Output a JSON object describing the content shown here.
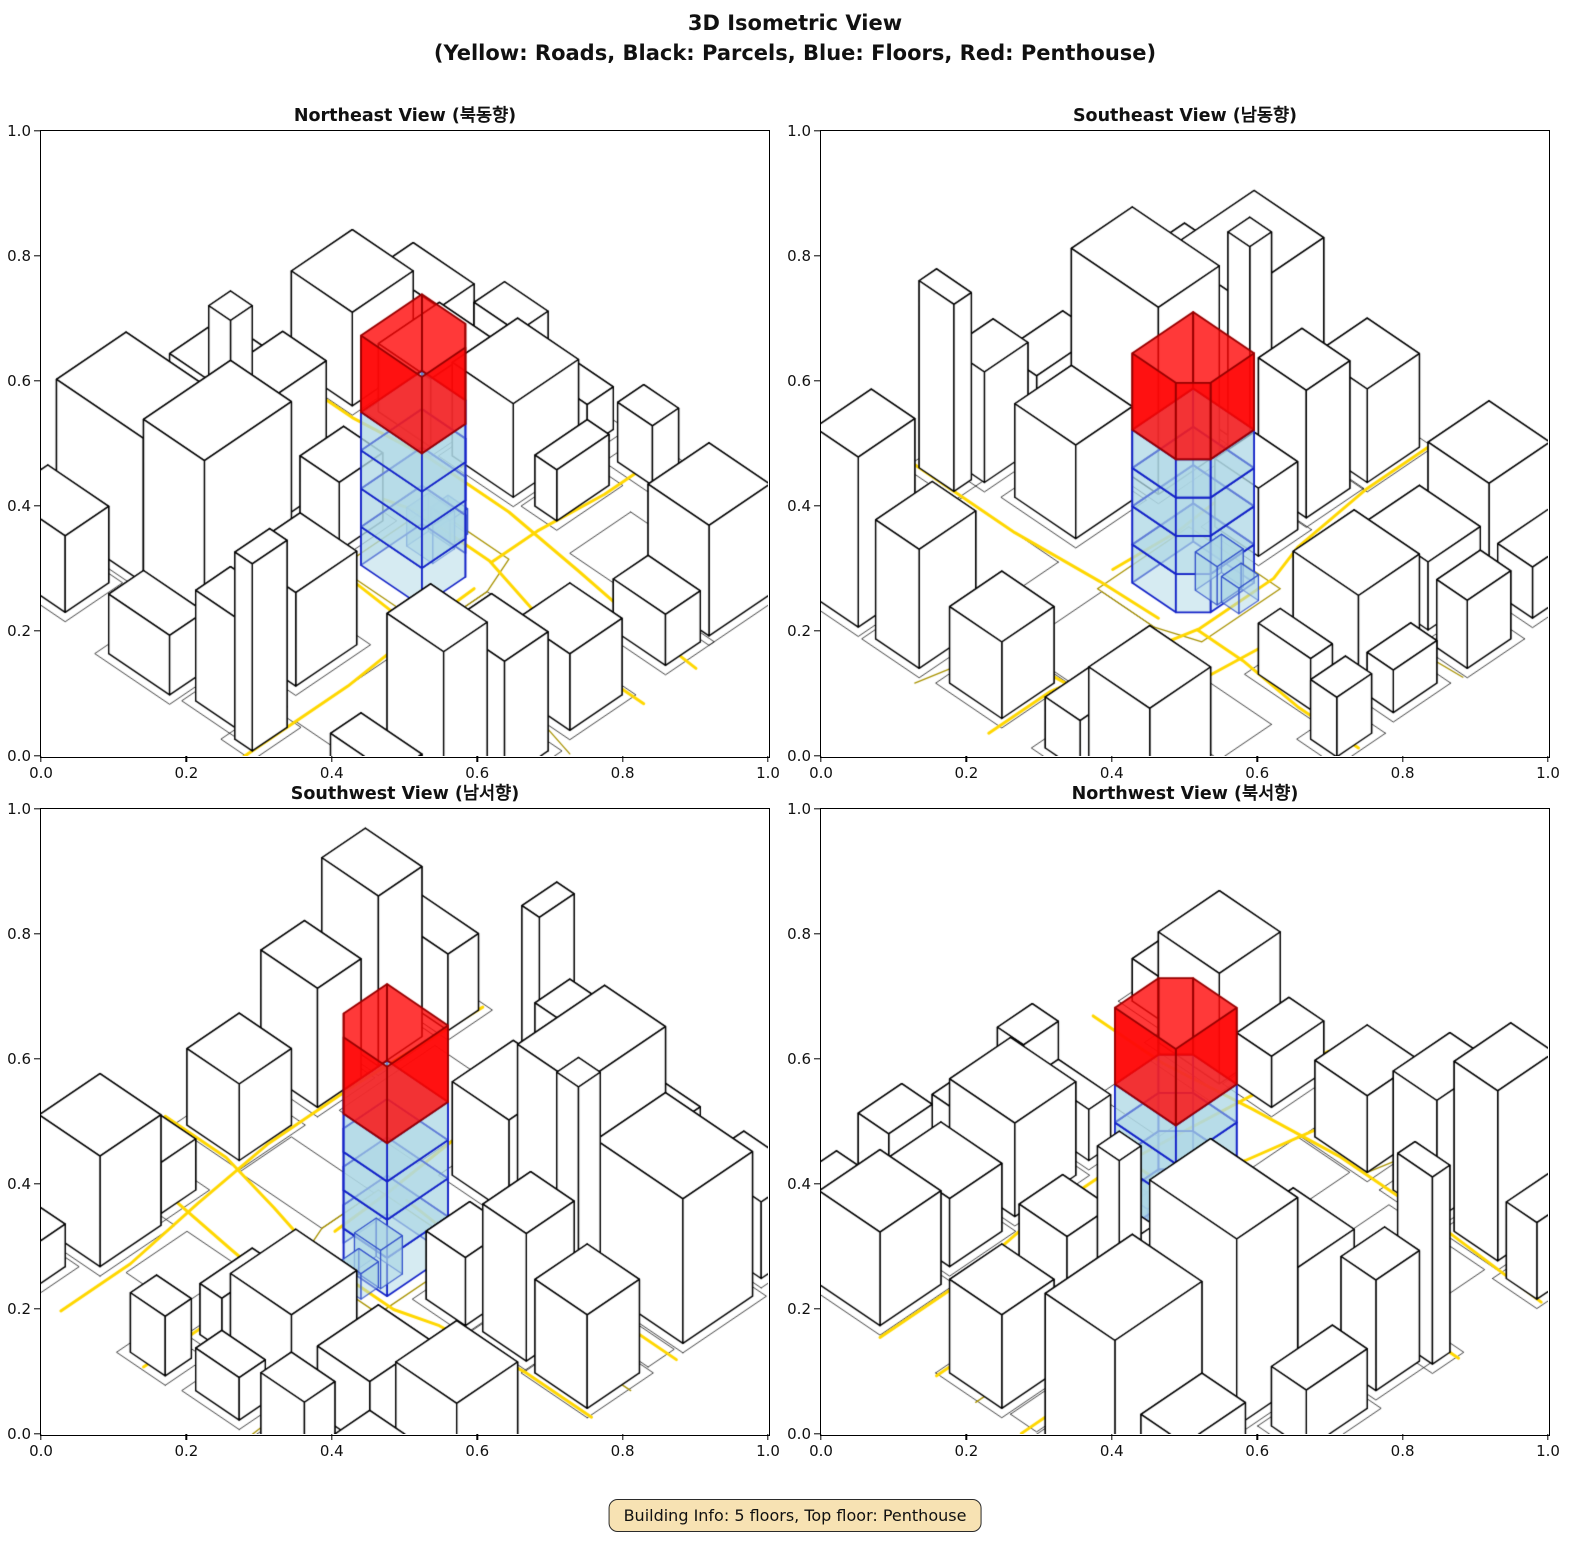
{
  "title": {
    "line1": "3D Isometric View",
    "line2": "(Yellow: Roads, Black: Parcels, Blue: Floors, Red: Penthouse)"
  },
  "footer": {
    "building_info": "Building Info: 5 floors, Top floor: Penthouse"
  },
  "axes": {
    "ticks": [
      "0.0",
      "0.2",
      "0.4",
      "0.6",
      "0.8",
      "1.0"
    ]
  },
  "colors": {
    "road": "#FFD700",
    "road_minor": "#A89200",
    "parcel": "#101010",
    "building_fill": "#FFFFFF",
    "building_edge": "#000000",
    "floor_fill": "rgba(173,216,230,0.5)",
    "floor_edge": "#1423C8",
    "penthouse_fill": "rgba(255,8,8,0.8)",
    "penthouse_edge": "#990000",
    "badge_bg": "#F7E2B3",
    "badge_border": "#2b2b2b"
  },
  "chart_data": {
    "type": "3d-isometric-city",
    "title": "3D Isometric View",
    "legend": {
      "Yellow": "Roads",
      "Black": "Parcels",
      "Blue": "Floors",
      "Red": "Penthouse"
    },
    "axis_range": [
      0.0,
      1.0
    ],
    "tick_step": 0.2,
    "building_info": {
      "floors": 5,
      "top_floor": "Penthouse"
    },
    "views": [
      {
        "id": "ne",
        "title": "Northeast View (북동향)",
        "rotation_deg": 0
      },
      {
        "id": "se",
        "title": "Southeast View (남동향)",
        "rotation_deg": 90
      },
      {
        "id": "sw",
        "title": "Southwest View (남서향)",
        "rotation_deg": 180
      },
      {
        "id": "nw",
        "title": "Northwest View (북서향)",
        "rotation_deg": 270
      }
    ],
    "scene": {
      "buildings": [
        [
          0.02,
          0.66,
          0.2,
          0.16,
          0.17
        ],
        [
          0.26,
          0.66,
          0.14,
          0.2,
          0.22
        ],
        [
          0.44,
          0.68,
          0.13,
          0.14,
          0.11
        ],
        [
          0.2,
          0.6,
          0.05,
          0.05,
          0.26
        ],
        [
          0.84,
          0.64,
          0.13,
          0.1,
          0.14
        ],
        [
          0.84,
          0.78,
          0.13,
          0.1,
          0.2
        ],
        [
          0.04,
          0.86,
          0.14,
          0.1,
          0.09
        ],
        [
          0.3,
          0.9,
          0.14,
          0.08,
          0.07
        ],
        [
          0.48,
          0.88,
          0.1,
          0.08,
          0.13
        ],
        [
          0.59,
          0.9,
          0.04,
          0.08,
          0.22
        ],
        [
          0.82,
          0.92,
          0.14,
          0.07,
          0.09
        ],
        [
          0.02,
          0.44,
          0.12,
          0.12,
          0.11
        ],
        [
          0.17,
          0.45,
          0.1,
          0.11,
          0.15
        ],
        [
          0.3,
          0.44,
          0.09,
          0.1,
          0.08
        ],
        [
          0.84,
          0.46,
          0.12,
          0.12,
          0.09
        ],
        [
          0.02,
          0.14,
          0.14,
          0.14,
          0.11
        ],
        [
          0.2,
          0.12,
          0.12,
          0.14,
          0.08
        ],
        [
          0.36,
          0.1,
          0.14,
          0.15,
          0.11
        ],
        [
          0.54,
          0.12,
          0.05,
          0.12,
          0.06
        ],
        [
          0.82,
          0.12,
          0.14,
          0.14,
          0.13
        ],
        [
          0.84,
          0.28,
          0.12,
          0.08,
          0.06
        ],
        [
          0.04,
          0.02,
          0.14,
          0.08,
          0.06
        ],
        [
          0.24,
          0.01,
          0.1,
          0.07,
          0.08
        ],
        [
          0.4,
          0.02,
          0.1,
          0.06,
          0.05
        ],
        [
          0.56,
          0.01,
          0.08,
          0.06,
          0.07
        ],
        [
          0.86,
          0.02,
          0.1,
          0.06,
          0.05
        ]
      ],
      "empty_parcels": [
        [
          0.63,
          0.44,
          0.19,
          0.12
        ],
        [
          0.66,
          0.14,
          0.12,
          0.14
        ],
        [
          0.63,
          0.66,
          0.18,
          0.22
        ],
        [
          0.02,
          0.58,
          0.12,
          0.06
        ]
      ],
      "roads": [
        [
          [
            0,
            0.3
          ],
          [
            0.18,
            0.3
          ],
          [
            0.34,
            0.28
          ],
          [
            0.52,
            0.28
          ],
          [
            0.7,
            0.3
          ],
          [
            0.86,
            0.32
          ],
          [
            1,
            0.33
          ]
        ],
        [
          [
            0,
            0.43
          ],
          [
            0.15,
            0.43
          ],
          [
            0.33,
            0.41
          ],
          [
            0.41,
            0.385
          ],
          [
            0.58,
            0.385
          ],
          [
            0.72,
            0.42
          ],
          [
            0.86,
            0.45
          ],
          [
            1,
            0.45
          ]
        ],
        [
          [
            0.6,
            0
          ],
          [
            0.6,
            0.14
          ],
          [
            0.585,
            0.28
          ],
          [
            0.585,
            0.385
          ]
        ],
        [
          [
            0.61,
            0.45
          ],
          [
            0.615,
            0.58
          ],
          [
            0.63,
            0.76
          ],
          [
            0.63,
            1
          ]
        ],
        [
          [
            0.79,
            0
          ],
          [
            0.79,
            0.16
          ],
          [
            0.815,
            0.34
          ],
          [
            0.835,
            0.52
          ],
          [
            0.835,
            0.72
          ],
          [
            0.82,
            1
          ]
        ],
        [
          [
            0,
            0.625
          ],
          [
            0.14,
            0.625
          ],
          [
            0.3,
            0.585
          ],
          [
            0.44,
            0.575
          ],
          [
            0.58,
            0.585
          ]
        ]
      ],
      "minor_lines": [
        [
          [
            0.42,
            0.36
          ],
          [
            0.6,
            0.36
          ],
          [
            0.63,
            0.44
          ],
          [
            0.63,
            0.57
          ],
          [
            0.42,
            0.57
          ],
          [
            0.42,
            0.36
          ]
        ],
        [
          [
            0,
            0.52
          ],
          [
            0.15,
            0.52
          ],
          [
            0.29,
            0.5
          ]
        ],
        [
          [
            0.36,
            0
          ],
          [
            0.37,
            0.14
          ],
          [
            0.39,
            0.26
          ]
        ],
        [
          [
            0.84,
            0.58
          ],
          [
            1,
            0.62
          ]
        ]
      ],
      "central_building": {
        "footprint": [
          [
            0.44,
            0.4
          ],
          [
            0.54,
            0.4
          ],
          [
            0.58,
            0.44
          ],
          [
            0.58,
            0.54
          ],
          [
            0.44,
            0.54
          ]
        ],
        "floor_height": 0.045,
        "num_floors": 4,
        "penthouse": {
          "z0": 0.18,
          "z1": 0.27
        },
        "annexes": [
          {
            "rect": [
              0.46,
              0.405,
              0.06,
              0.05
            ],
            "z0": 0,
            "z1": 0.045
          },
          {
            "rect": [
              0.465,
              0.365,
              0.045,
              0.04
            ],
            "z0": 0,
            "z1": 0.03
          }
        ]
      }
    }
  }
}
